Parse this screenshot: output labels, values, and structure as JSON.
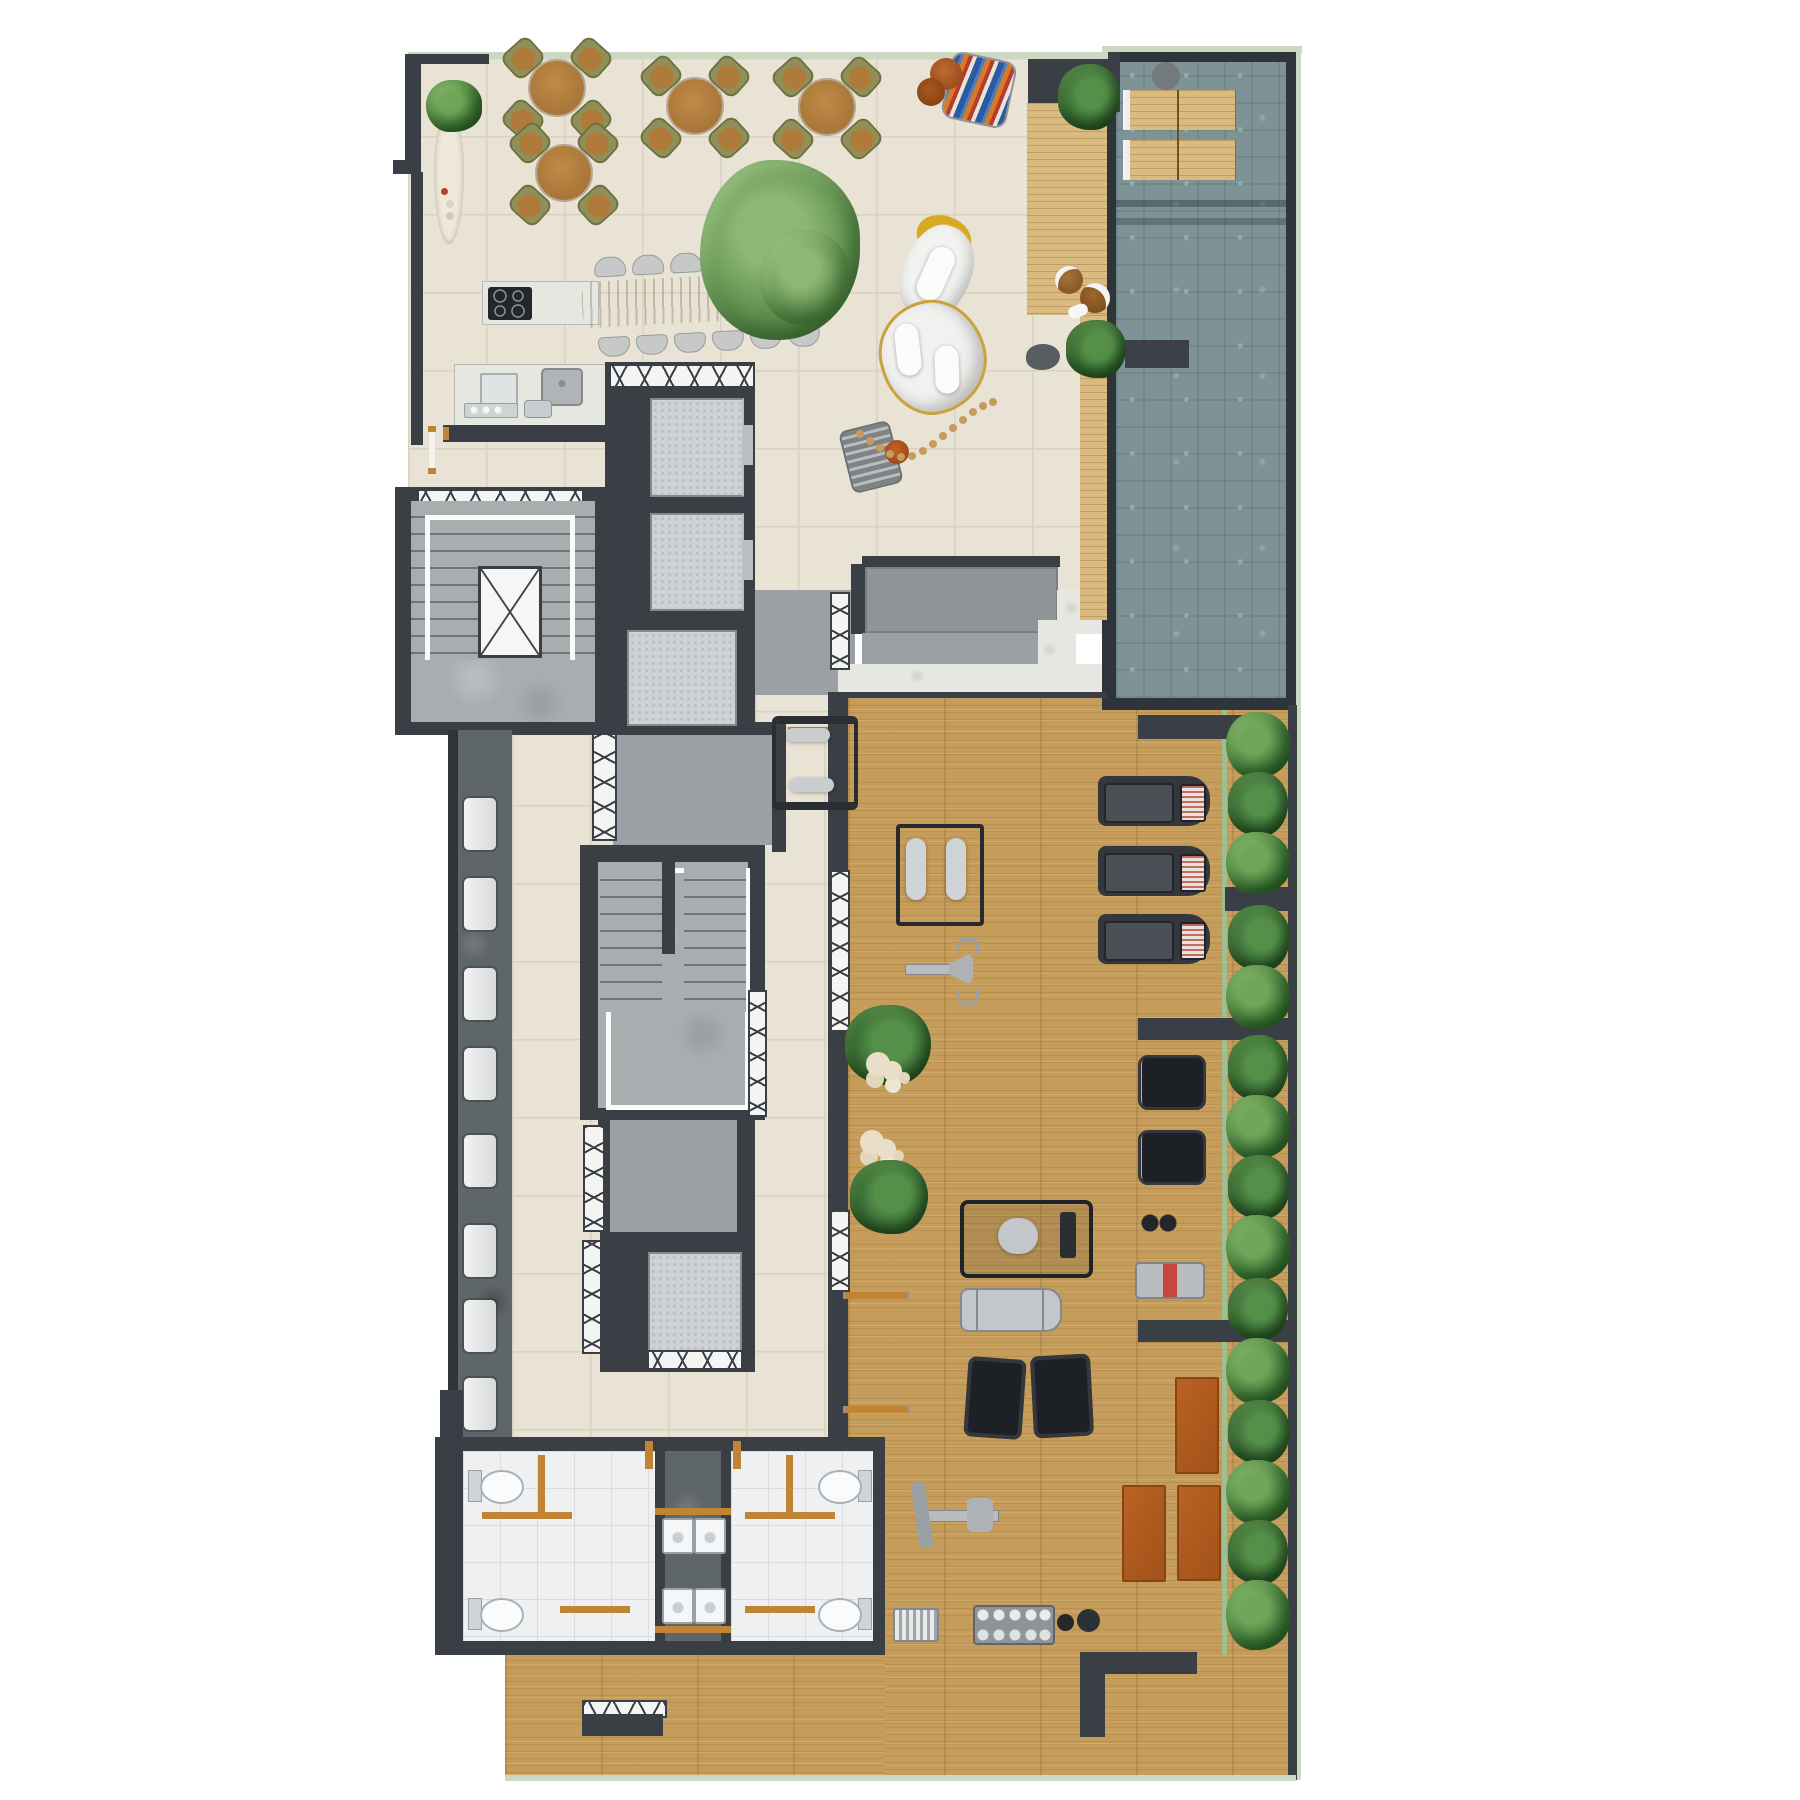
{
  "scene": {
    "kind": "architectural floor plan - top-down 3D render",
    "level": "residential amenity level with pool, lounge and gym",
    "canvas": "1800x1800",
    "background": "#ffffff",
    "visible_text": "none"
  },
  "palette": {
    "wall": "#3a3f45",
    "terrace_tile": "#e9e3d5",
    "tile_grout": "#d9d2c2",
    "gym_wood": "#c59c59",
    "deck_wood": "#d9ba80",
    "pool_water": "#7d9396",
    "coping_line": "#ccd8c2",
    "concrete": "#a8adb0",
    "elevator_cabin": "#ced2d6",
    "bathroom_tile": "#eef0f2",
    "stone_floor": "#5f666a",
    "hedge_green": "#3f7a39",
    "furniture_wood": "#b5813f",
    "chair_olive": "#8f9058",
    "mat_orange": "#b05c1e",
    "marble": "#e7e7e2",
    "accent_yellow": "#d9a921",
    "pouf_orange": "#b3541e"
  },
  "regions": {
    "terrace": {
      "label": "Outdoor terrace with four round cafe tables"
    },
    "kitchen": {
      "label": "Shared kitchen - cooktop island and sink counter with coffee machine"
    },
    "dining": {
      "label": "Live-edge communal dining table with twelve chairs"
    },
    "lounge": {
      "label": "Lounge with organic white sofas, hammock chair and pebble path"
    },
    "spa": {
      "label": "Bar / massage counter with marble threshold"
    },
    "deck": {
      "label": "Timber pool deck with round side tables"
    },
    "pool": {
      "label": "Swimming pool with submerged loungers and bench"
    },
    "stair_upper": {
      "label": "Upper stairwell with central light well"
    },
    "elevator_bank": {
      "label": "Elevator bank - three cabins"
    },
    "corridor": {
      "label": "Service corridor with eight benches"
    },
    "vestibule_a": {
      "label": "Vestibule to fitness room"
    },
    "stair_lower": {
      "label": "Lower stairwell"
    },
    "vestibule_b": {
      "label": "Lower vestibule"
    },
    "elevator_b": {
      "label": "Single elevator cabin"
    },
    "bathrooms": {
      "label": "Changing rooms - toilets, benches and double vanities"
    },
    "gym": {
      "label": "Fitness room with cardio and strength equipment"
    },
    "hedge": {
      "label": "Planted hedge along east wall"
    }
  },
  "inventory": {
    "terrace_round_tables": 4,
    "chairs_per_round_table": 4,
    "dining_chairs": 12,
    "lounge_sofas": 2,
    "hammock_chairs": 1,
    "pool_loungers": 4,
    "deck_side_tables": 2,
    "corridor_benches": 8,
    "elevator_cabins": 4,
    "toilets": 4,
    "vanity_sinks": 4,
    "treadmills": 3,
    "stair_climbers": 2,
    "exercise_mats": 3,
    "gym_machines": [
      "barbell rack",
      "bench press station",
      "pec-deck machine",
      "leg press",
      "adjustable bench",
      "flat benches",
      "rowing station",
      "dumbbell rack",
      "aerobic step stack",
      "medicine balls"
    ]
  }
}
